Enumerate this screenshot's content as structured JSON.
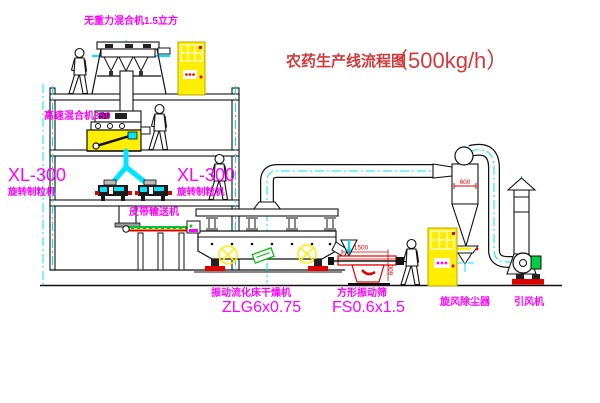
{
  "title": {
    "name": "农药生产线流程图",
    "capacity": "（500kg/h）"
  },
  "equipment_labels": {
    "gravity_mixer": "无重力混合机1.5立方",
    "high_speed_mixer": "高速混合机350",
    "granulator_left": {
      "model": "XL-300",
      "name": "旋转制粒机"
    },
    "granulator_right": {
      "model": "XL-300",
      "name": "旋转制粒机"
    },
    "belt_conveyor": "皮带输送机",
    "fluid_bed_dryer": {
      "name": "振动流化床干燥机",
      "model": "ZLG6x0.75"
    },
    "vibrating_screen": {
      "name": "方形振动筛",
      "model": "FS0.6x1.5"
    },
    "cyclone": "旋风除尘器",
    "induced_draft_fan": "引风机"
  },
  "dimensions": {
    "screen_length": "1500",
    "screen_height": "600",
    "cyclone_width": "600"
  },
  "colors": {
    "label_magenta": "#ff00ff",
    "title_red": "#d03a3a",
    "accent_red": "#e00000",
    "centerline_cyan": "#00e5ff",
    "highlight_yellow": "#ffee00",
    "motor_green": "#00cc44",
    "line_black": "#111111",
    "background": "#ffffff"
  }
}
